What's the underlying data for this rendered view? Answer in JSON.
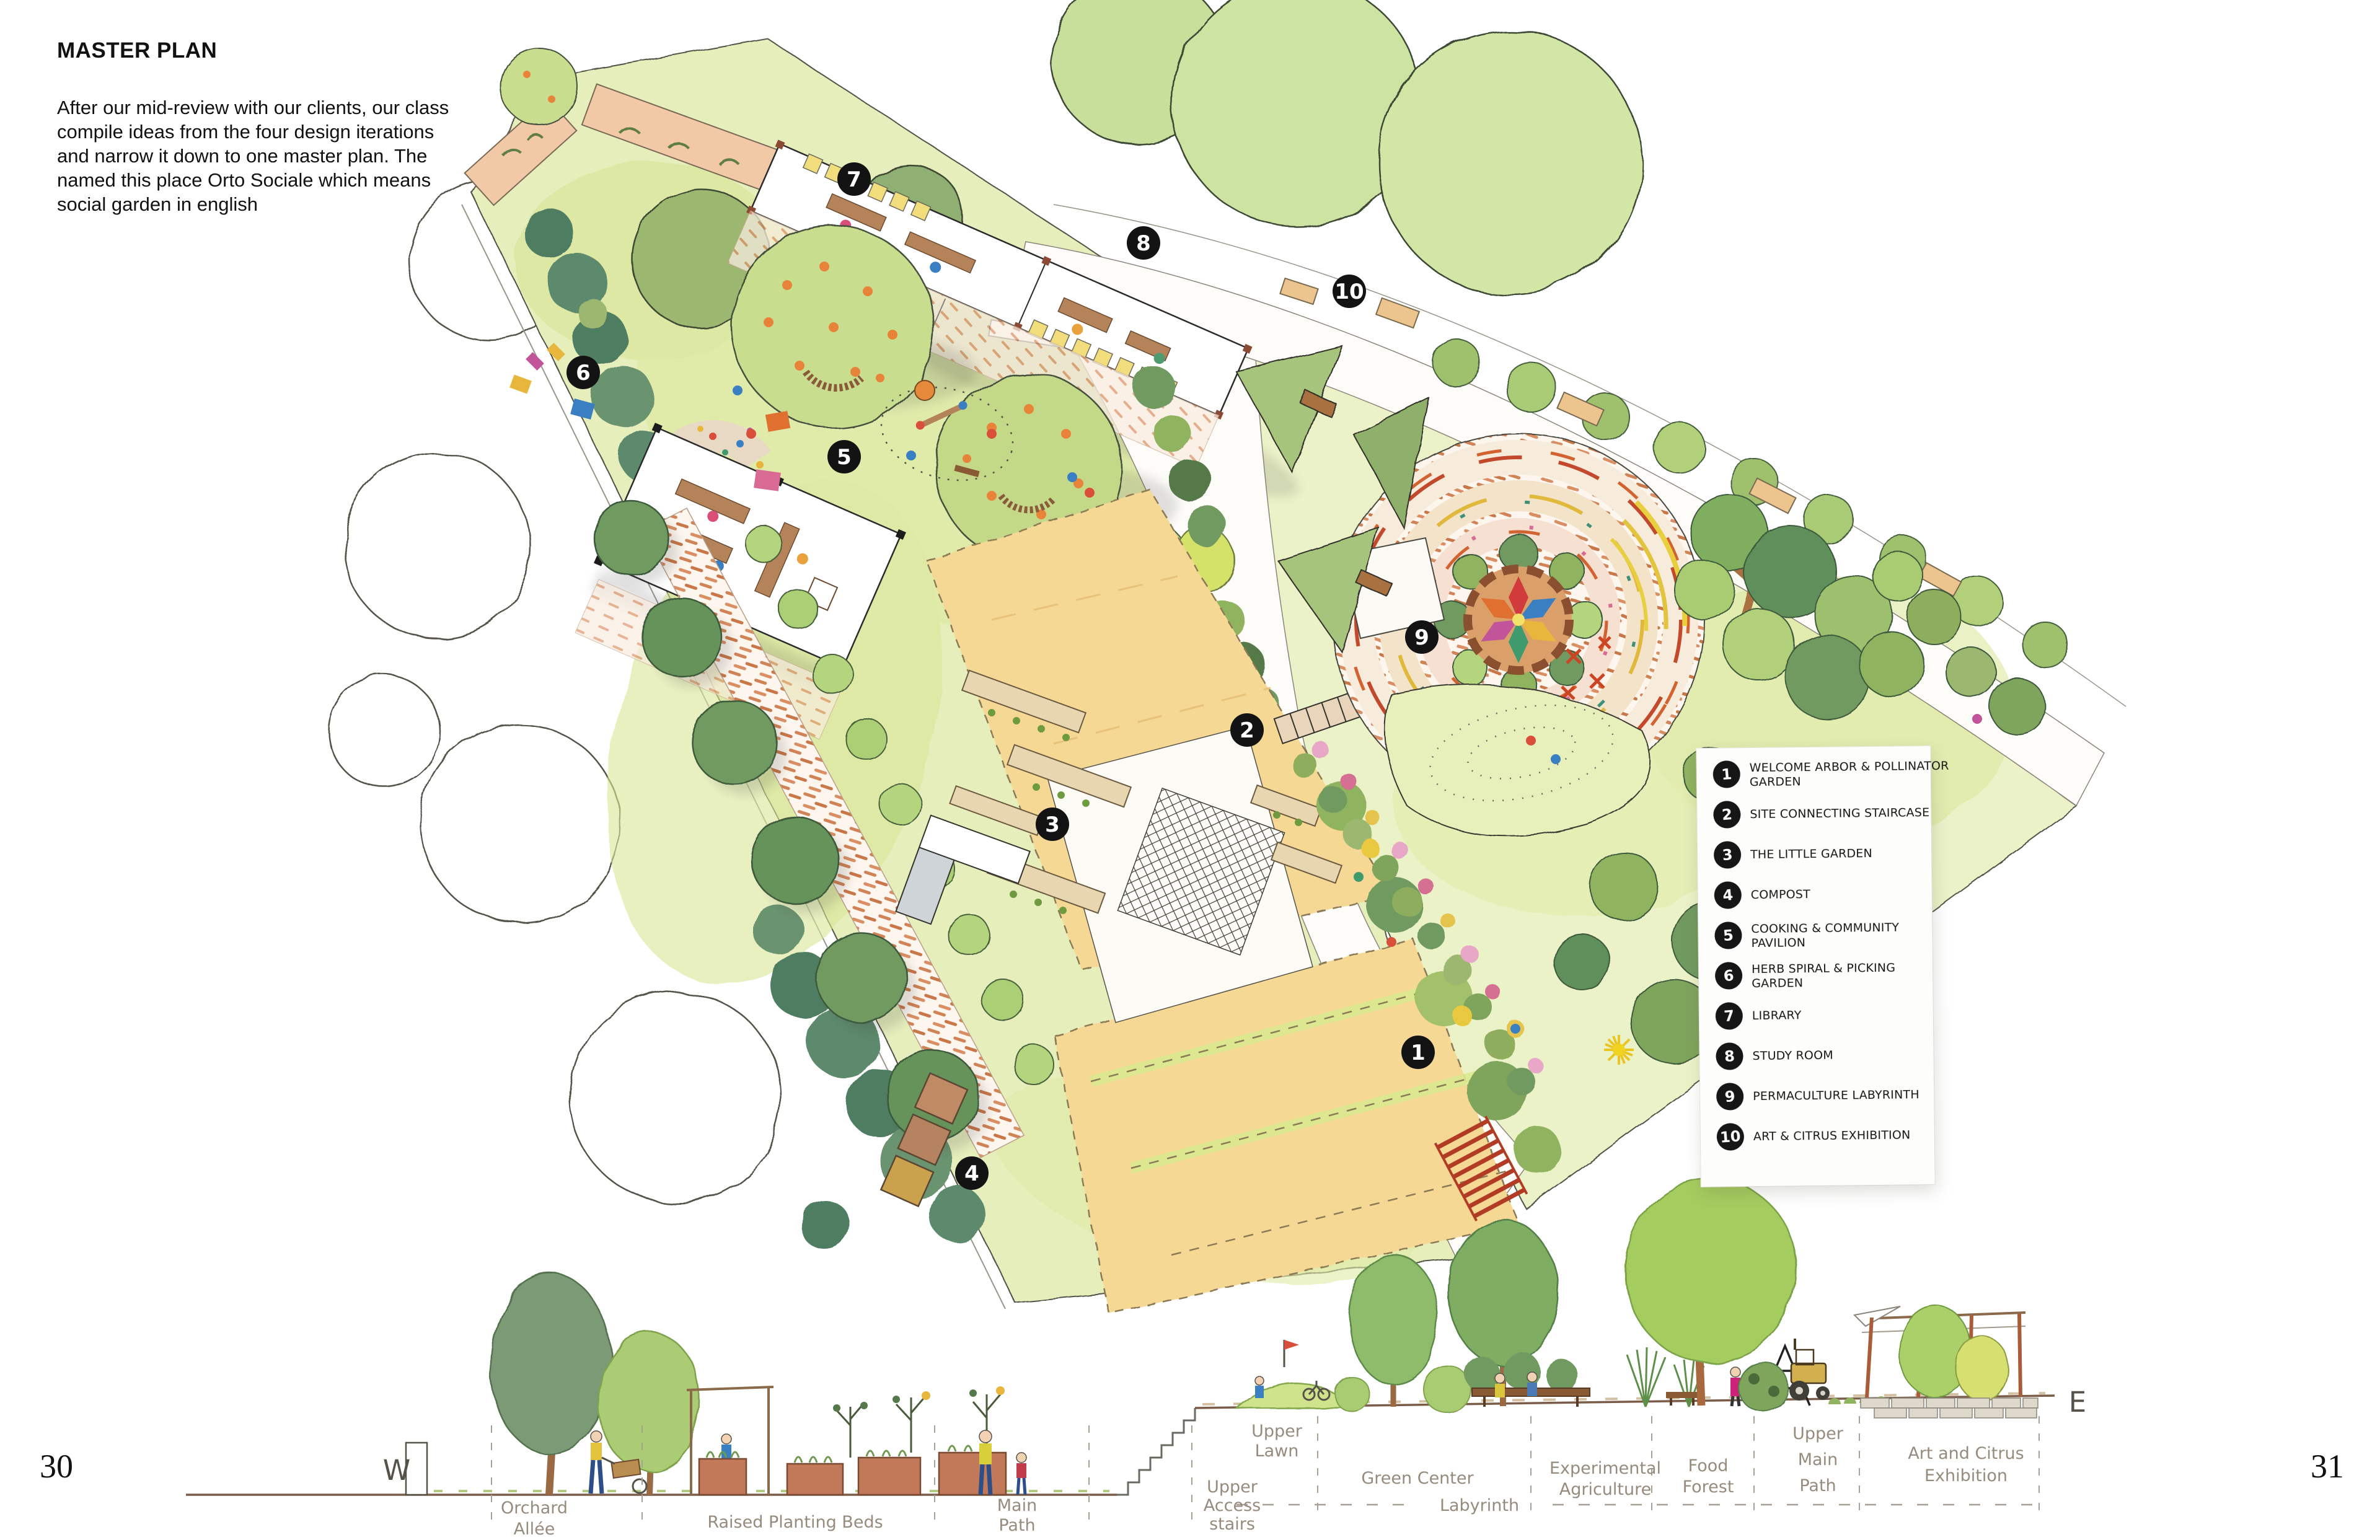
{
  "page": {
    "title": "MASTER PLAN",
    "paragraph": "After our mid-review with our clients, our class compile ideas from the four design iterations and narrow it down to one master plan. The named this place Orto Sociale which means social garden in english",
    "page_left": "30",
    "page_right": "31"
  },
  "legend": {
    "items": [
      {
        "num": "1",
        "line1": "WELCOME ARBOR & POLLINATOR",
        "line2": "GARDEN"
      },
      {
        "num": "2",
        "line1": "SITE CONNECTING STAIRCASE",
        "line2": ""
      },
      {
        "num": "3",
        "line1": "THE LITTLE GARDEN",
        "line2": ""
      },
      {
        "num": "4",
        "line1": "COMPOST",
        "line2": ""
      },
      {
        "num": "5",
        "line1": "COOKING & COMMUNITY",
        "line2": "PAVILION"
      },
      {
        "num": "6",
        "line1": "HERB SPIRAL & PICKING",
        "line2": "GARDEN"
      },
      {
        "num": "7",
        "line1": "LIBRARY",
        "line2": ""
      },
      {
        "num": "8",
        "line1": "STUDY ROOM",
        "line2": ""
      },
      {
        "num": "9",
        "line1": "PERMACULTURE LABYRINTH",
        "line2": ""
      },
      {
        "num": "10",
        "line1": "ART & CITRUS EXHIBITION",
        "line2": ""
      }
    ]
  },
  "markers": [
    "1",
    "2",
    "3",
    "4",
    "5",
    "6",
    "7",
    "8",
    "9",
    "10"
  ],
  "section": {
    "west": "W",
    "east": "E",
    "labels": [
      {
        "lines": [
          "Orchard",
          "Allée"
        ]
      },
      {
        "lines": [
          "Raised Planting Beds"
        ]
      },
      {
        "lines": [
          "Main",
          "Path"
        ]
      },
      {
        "lines": [
          "Upper",
          "Access",
          "stairs"
        ]
      },
      {
        "lines": [
          "Upper",
          "Lawn"
        ]
      },
      {
        "lines": [
          "Green Center"
        ]
      },
      {
        "lines": [
          "Experimental",
          "Agriculture"
        ]
      },
      {
        "lines": [
          "Food",
          "Forest"
        ]
      },
      {
        "lines": [
          "Upper",
          "Main",
          "Path"
        ]
      },
      {
        "lines": [
          "Art and Citrus",
          "Exhibition"
        ]
      },
      {
        "lines": [
          "Labyrinth"
        ]
      }
    ]
  },
  "colors": {
    "marker": "#131313",
    "lawn": "#e6eebc",
    "lawn_right": "#ecf2c8",
    "field_tan": "#f4d894",
    "brick_path": "#d0835a",
    "planter_brick": "#c1795a",
    "tree_dark": "#6f9a5f",
    "tree_light": "#b5d47e",
    "citrus_fruit": "#e8833a",
    "handwriting": "#968b7d",
    "ink": "#1a1a1a"
  }
}
